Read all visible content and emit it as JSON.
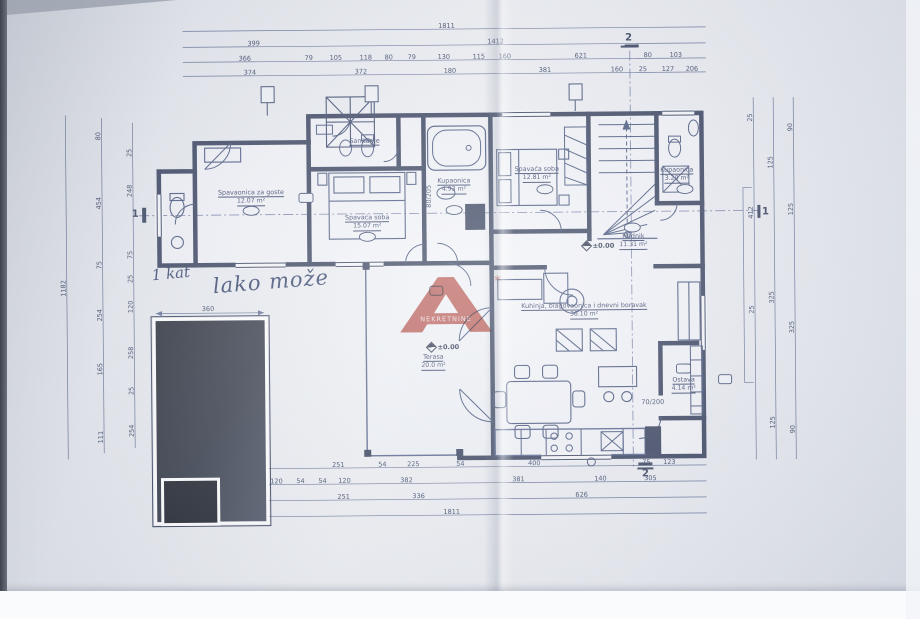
{
  "document": {
    "kind": "scanned architectural floor plan"
  },
  "watermark": {
    "mark": "A",
    "text": "NEKRETNINE",
    "symbol": "*",
    "color": "#b23a31"
  },
  "handwriting": {
    "prefix": "1 kat",
    "note": "lako može"
  },
  "levels": {
    "hall": "±0.00",
    "terrace": "±0.00"
  },
  "section_markers": {
    "top": "2",
    "bottom": "2",
    "left": "1",
    "right": "1"
  },
  "rooms": [
    {
      "label": "Spavaonica za goste",
      "area": "12.07 m²"
    },
    {
      "label": "Spavaća soba",
      "area": "15.07 m²"
    },
    {
      "label": "Kupaonica",
      "area": "4.93 m²"
    },
    {
      "label": "Spavaća soba",
      "area": "12.81 m²"
    },
    {
      "label": "Hodnik",
      "area": "11.31 m²"
    },
    {
      "label": "Kupaonica",
      "area": "3.20 m²"
    },
    {
      "label": "Sanitarije",
      "area": ""
    },
    {
      "label": "Terasa",
      "area": "20.0 m²"
    },
    {
      "label": "Kuhinja, blagovaonica i dnevni boravak",
      "area": "36.10 m²"
    },
    {
      "label": "Ostava",
      "area": "4.14 m²"
    }
  ],
  "dimensions": {
    "all": [
      {
        "v": "1811",
        "x": 449,
        "y": 26
      },
      {
        "v": "399",
        "x": 256,
        "y": 42
      },
      {
        "v": "1412",
        "x": 498,
        "y": 42
      },
      {
        "v": "366",
        "x": 247,
        "y": 57
      },
      {
        "v": "79",
        "x": 311,
        "y": 57
      },
      {
        "v": "105",
        "x": 338,
        "y": 57
      },
      {
        "v": "118",
        "x": 368,
        "y": 57
      },
      {
        "v": "80",
        "x": 391,
        "y": 57
      },
      {
        "v": "79",
        "x": 414,
        "y": 57
      },
      {
        "v": "130",
        "x": 446,
        "y": 57
      },
      {
        "v": "115",
        "x": 481,
        "y": 57
      },
      {
        "v": "160",
        "x": 507,
        "y": 57
      },
      {
        "v": "621",
        "x": 583,
        "y": 57
      },
      {
        "v": "80",
        "x": 650,
        "y": 57
      },
      {
        "v": "103",
        "x": 678,
        "y": 57
      },
      {
        "v": "374",
        "x": 252,
        "y": 71
      },
      {
        "v": "372",
        "x": 363,
        "y": 71
      },
      {
        "v": "180",
        "x": 452,
        "y": 71
      },
      {
        "v": "381",
        "x": 547,
        "y": 71
      },
      {
        "v": "160",
        "x": 619,
        "y": 71
      },
      {
        "v": "25",
        "x": 645,
        "y": 71
      },
      {
        "v": "127",
        "x": 670,
        "y": 71
      },
      {
        "v": "206",
        "x": 694,
        "y": 71
      },
      {
        "v": "251",
        "x": 337,
        "y": 464
      },
      {
        "v": "54",
        "x": 381,
        "y": 464
      },
      {
        "v": "225",
        "x": 412,
        "y": 464
      },
      {
        "v": "54",
        "x": 459,
        "y": 464
      },
      {
        "v": "400",
        "x": 533,
        "y": 464
      },
      {
        "v": "75",
        "x": 645,
        "y": 464
      },
      {
        "v": "123",
        "x": 668,
        "y": 464
      },
      {
        "v": "120",
        "x": 275,
        "y": 480
      },
      {
        "v": "54",
        "x": 299,
        "y": 480
      },
      {
        "v": "54",
        "x": 321,
        "y": 480
      },
      {
        "v": "120",
        "x": 343,
        "y": 480
      },
      {
        "v": "382",
        "x": 405,
        "y": 480
      },
      {
        "v": "381",
        "x": 517,
        "y": 480
      },
      {
        "v": "140",
        "x": 599,
        "y": 480
      },
      {
        "v": "305",
        "x": 649,
        "y": 480
      },
      {
        "v": "251",
        "x": 342,
        "y": 496
      },
      {
        "v": "336",
        "x": 417,
        "y": 496
      },
      {
        "v": "626",
        "x": 580,
        "y": 496
      },
      {
        "v": "1811",
        "x": 450,
        "y": 512
      },
      {
        "v": "1182",
        "x": 64,
        "y": 285,
        "r": -90
      },
      {
        "v": "80",
        "x": 100,
        "y": 133,
        "r": -90
      },
      {
        "v": "454",
        "x": 100,
        "y": 200,
        "r": -90
      },
      {
        "v": "75",
        "x": 100,
        "y": 262,
        "r": -90
      },
      {
        "v": "254",
        "x": 100,
        "y": 312,
        "r": -90
      },
      {
        "v": "165",
        "x": 100,
        "y": 366,
        "r": -90
      },
      {
        "v": "111",
        "x": 100,
        "y": 434,
        "r": -90
      },
      {
        "v": "25",
        "x": 131,
        "y": 150,
        "r": -90
      },
      {
        "v": "248",
        "x": 131,
        "y": 188,
        "r": -90
      },
      {
        "v": "75",
        "x": 131,
        "y": 252,
        "r": -90
      },
      {
        "v": "25",
        "x": 131,
        "y": 276,
        "r": -90
      },
      {
        "v": "120",
        "x": 131,
        "y": 304,
        "r": -90
      },
      {
        "v": "258",
        "x": 131,
        "y": 350,
        "r": -90
      },
      {
        "v": "25",
        "x": 131,
        "y": 388,
        "r": -90
      },
      {
        "v": "254",
        "x": 131,
        "y": 428,
        "r": -90
      },
      {
        "v": "25",
        "x": 752,
        "y": 120,
        "r": -90
      },
      {
        "v": "412",
        "x": 752,
        "y": 215,
        "r": -90
      },
      {
        "v": "25",
        "x": 752,
        "y": 312,
        "r": -90
      },
      {
        "v": "125",
        "x": 772,
        "y": 165,
        "r": -90
      },
      {
        "v": "325",
        "x": 772,
        "y": 300,
        "r": -90
      },
      {
        "v": "125",
        "x": 772,
        "y": 425,
        "r": -90
      },
      {
        "v": "90",
        "x": 792,
        "y": 130,
        "r": -90
      },
      {
        "v": "125",
        "x": 792,
        "y": 212,
        "r": -90
      },
      {
        "v": "325",
        "x": 792,
        "y": 330,
        "r": -90
      },
      {
        "v": "90",
        "x": 792,
        "y": 432,
        "r": -90
      },
      {
        "v": "360",
        "x": 208,
        "y": 307
      },
      {
        "v": "80/205",
        "x": 430,
        "y": 196,
        "r": -90
      },
      {
        "v": "70/200",
        "x": 652,
        "y": 404
      }
    ]
  }
}
